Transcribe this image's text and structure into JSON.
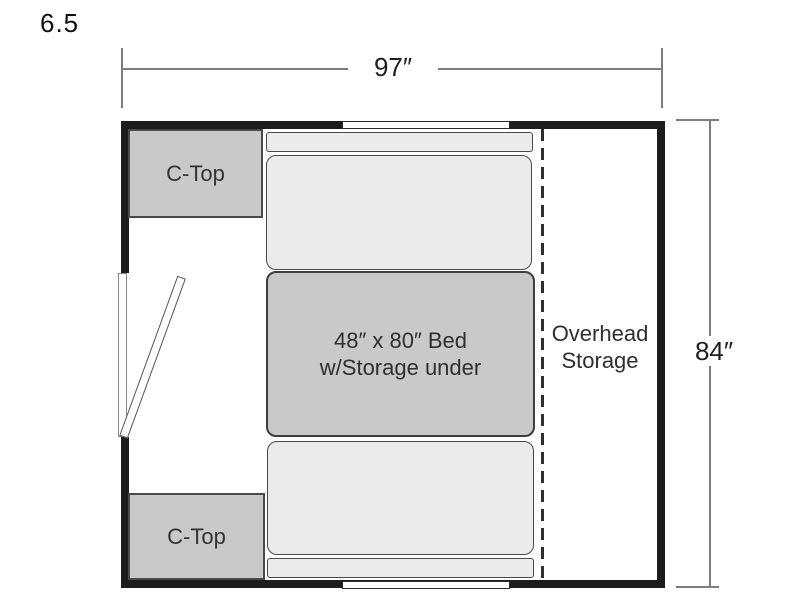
{
  "floorplan": {
    "model": "6.5",
    "dimensions": {
      "width_label": "97″",
      "height_label": "84″"
    },
    "labels": {
      "counter_top_upper": "C-Top",
      "counter_top_lower": "C-Top",
      "bed_line1": "48″ x 80″ Bed",
      "bed_line2": "w/Storage under",
      "overhead_line1": "Overhead",
      "overhead_line2": "Storage"
    },
    "colors": {
      "wall": "#1c1c1c",
      "counter_fill": "#c9c9c9",
      "bed_fill": "#c9c9c9",
      "cushion_fill": "#ebebeb",
      "dashed_divider": "#2e2e2e",
      "dimension_line": "#7d7d7d",
      "background": "#ffffff"
    }
  }
}
